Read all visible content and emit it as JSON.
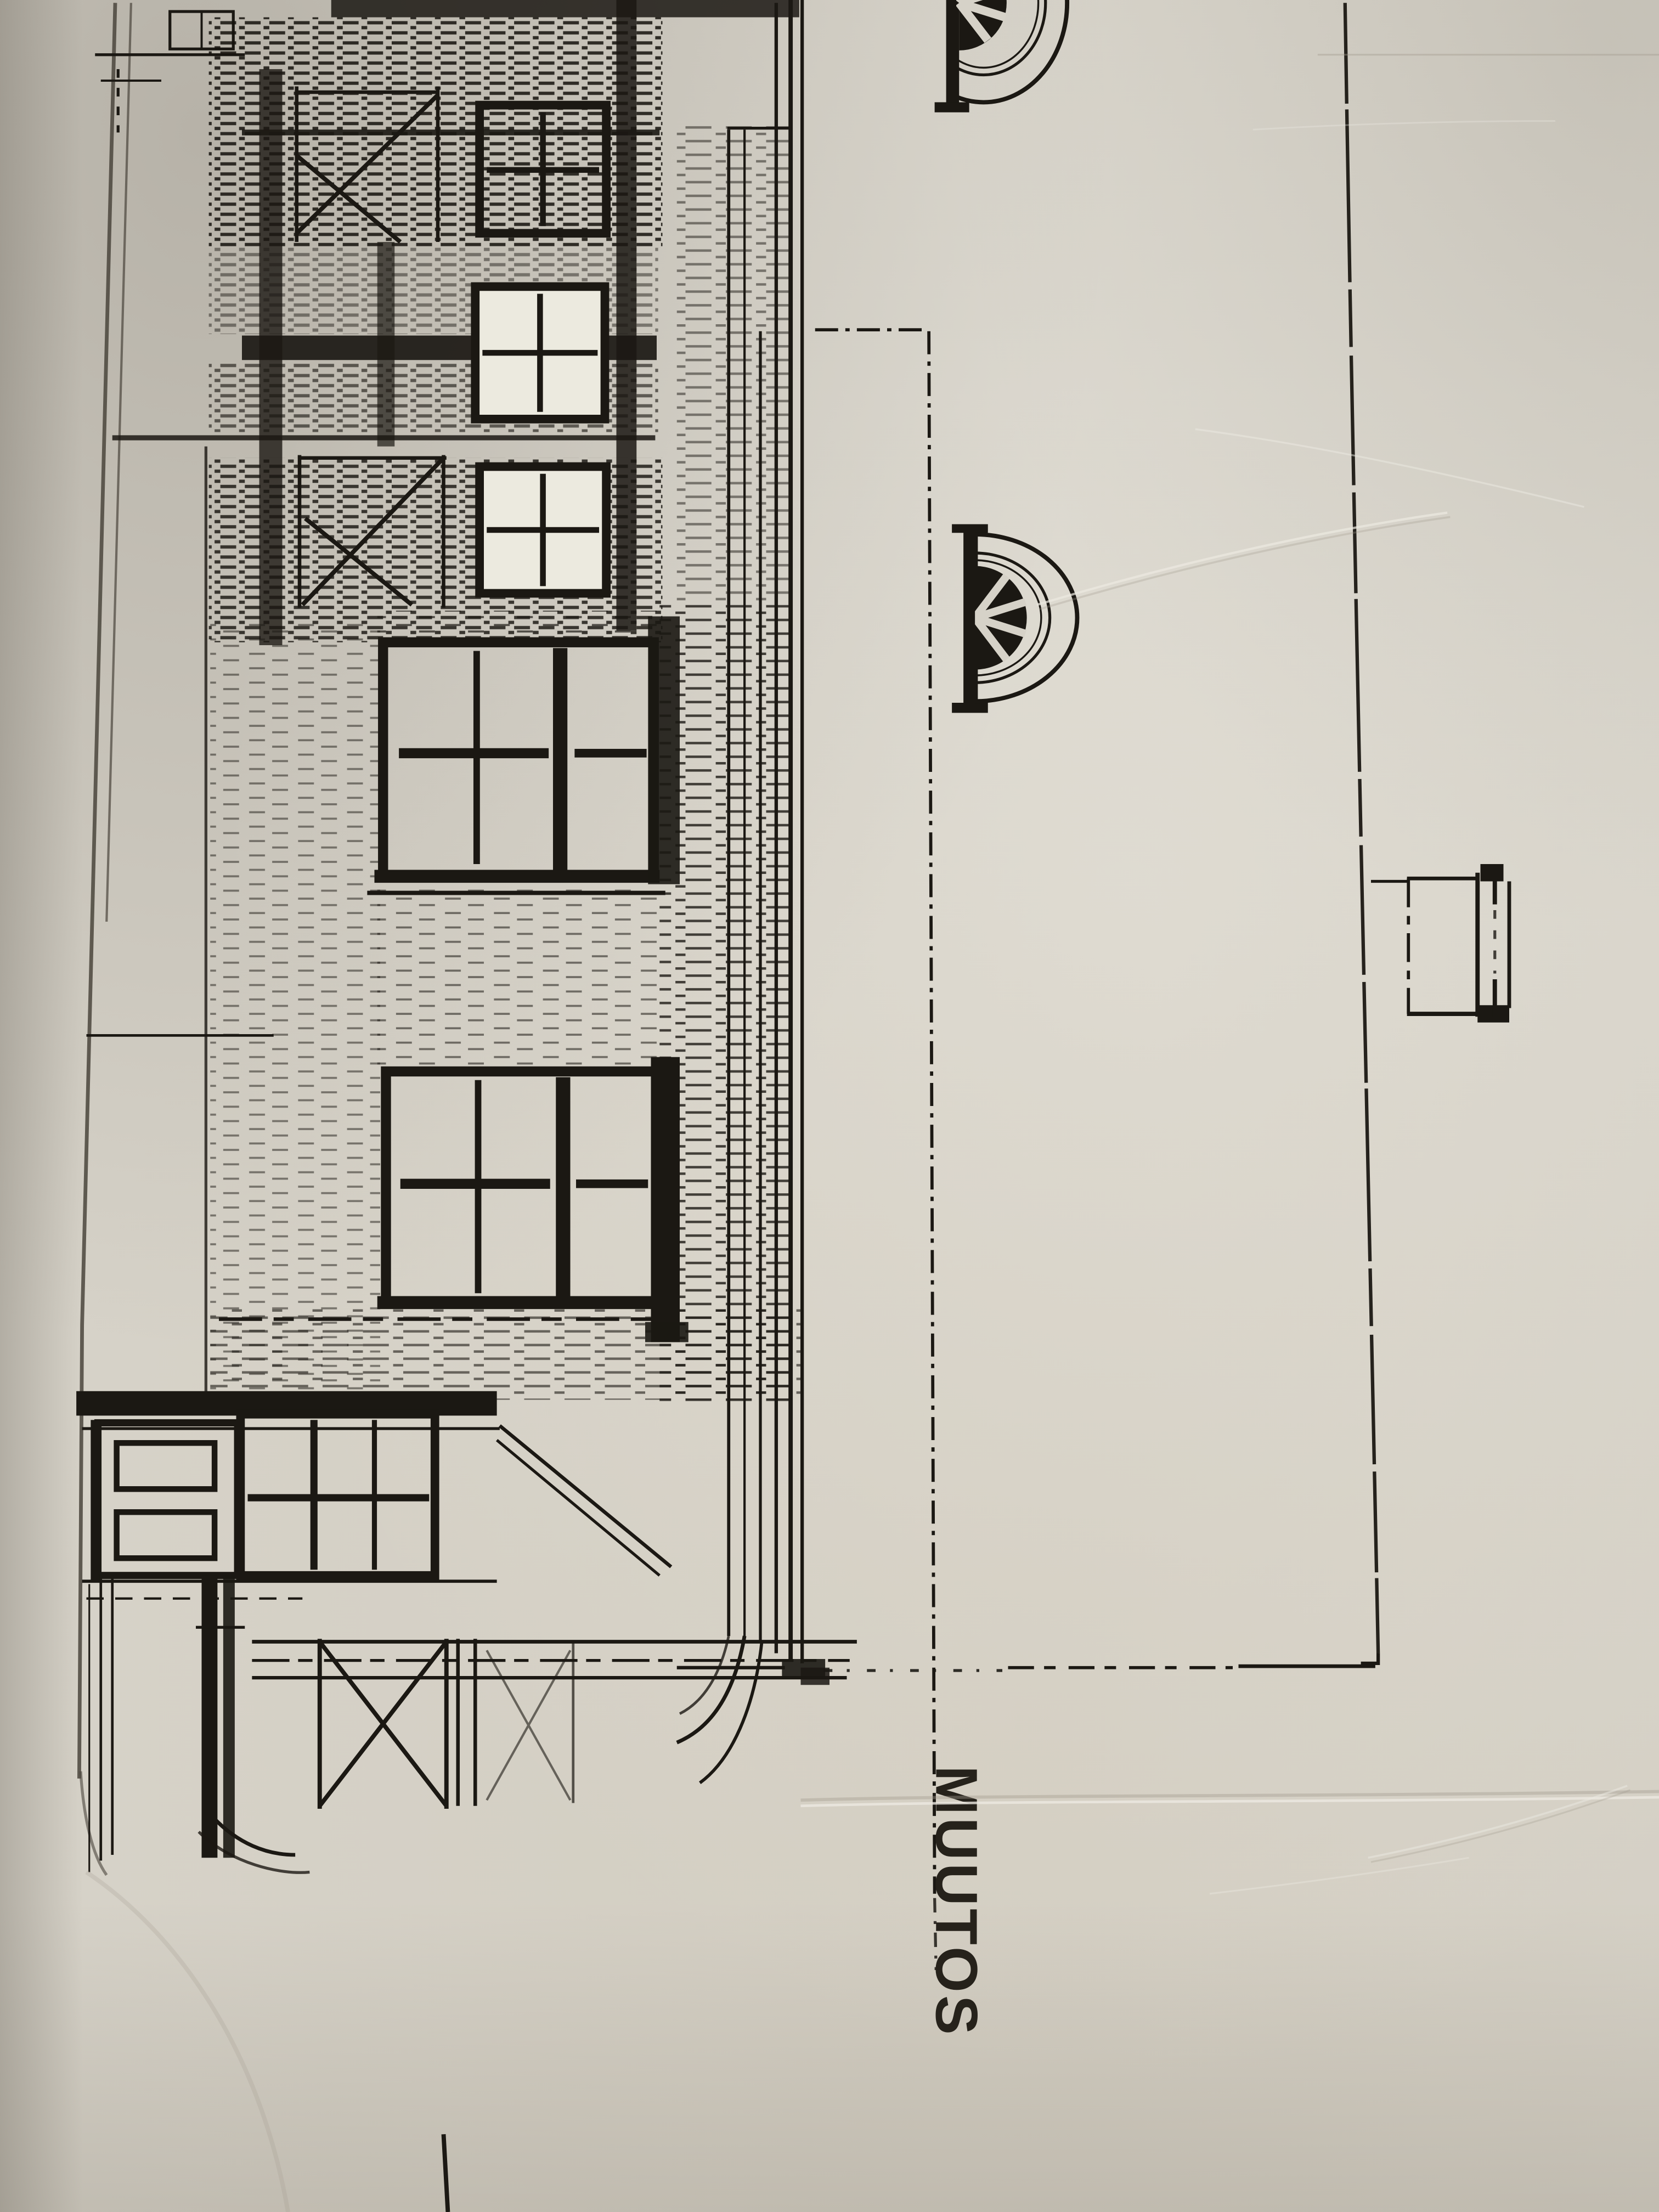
{
  "photo": {
    "paper_color": "#d6d2c8",
    "ink_color": "#1b1813",
    "pencil_color": "#4a453c",
    "description": "photograph of a photocopied architectural elevation drawing, rotated 90 degrees on the sheet"
  },
  "drawing": {
    "title_label": "MUUTOS",
    "elements": [
      "roof-edge-line",
      "side-elevation-facade",
      "stair-railing-zigzag",
      "small-four-pane-window-1",
      "small-four-pane-window-2",
      "small-four-pane-window-3",
      "six-pane-window-upper",
      "six-pane-window-lower",
      "porch-roof-bar",
      "porch-door",
      "porch-window",
      "porch-lattice-x-panel",
      "eave-board-bundle",
      "gable-corner-line",
      "dash-dot-boundary-line",
      "fan-window-top",
      "fan-window-middle",
      "gable-outline-right",
      "chimney-stub",
      "ground-tick-mark"
    ]
  }
}
